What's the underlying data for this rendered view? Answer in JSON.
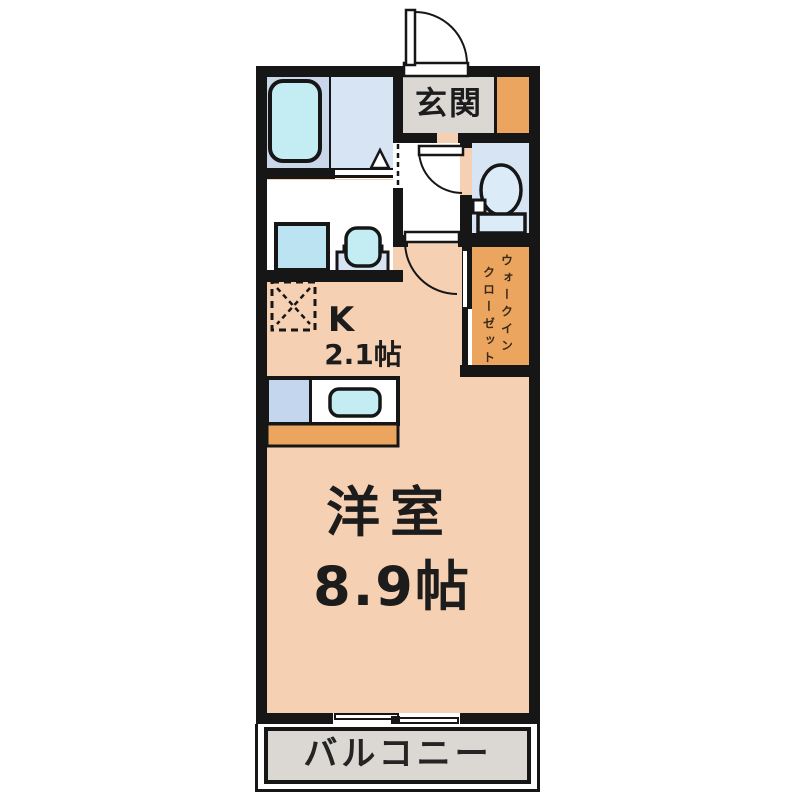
{
  "labels": {
    "entrance": "玄関",
    "kitchen_abbr": "K",
    "kitchen_size": "2.1帖",
    "main_room": "洋室",
    "main_room_size": "8.9帖",
    "balcony": "バルコニー",
    "wic_line1": "ウォークイン",
    "wic_line2": "クローゼット"
  },
  "colors": {
    "wall": "#161616",
    "floor": "#f6d0b2",
    "orange": "#eca55f",
    "gray": "#dbd8d3",
    "bluefloor": "#d7e4f4",
    "panel": "#cad7eb",
    "cyan": "#c3edf3",
    "washer": "#bce3f2",
    "counterblue": "#c3d6ee",
    "fixture": "#dcebf8"
  }
}
